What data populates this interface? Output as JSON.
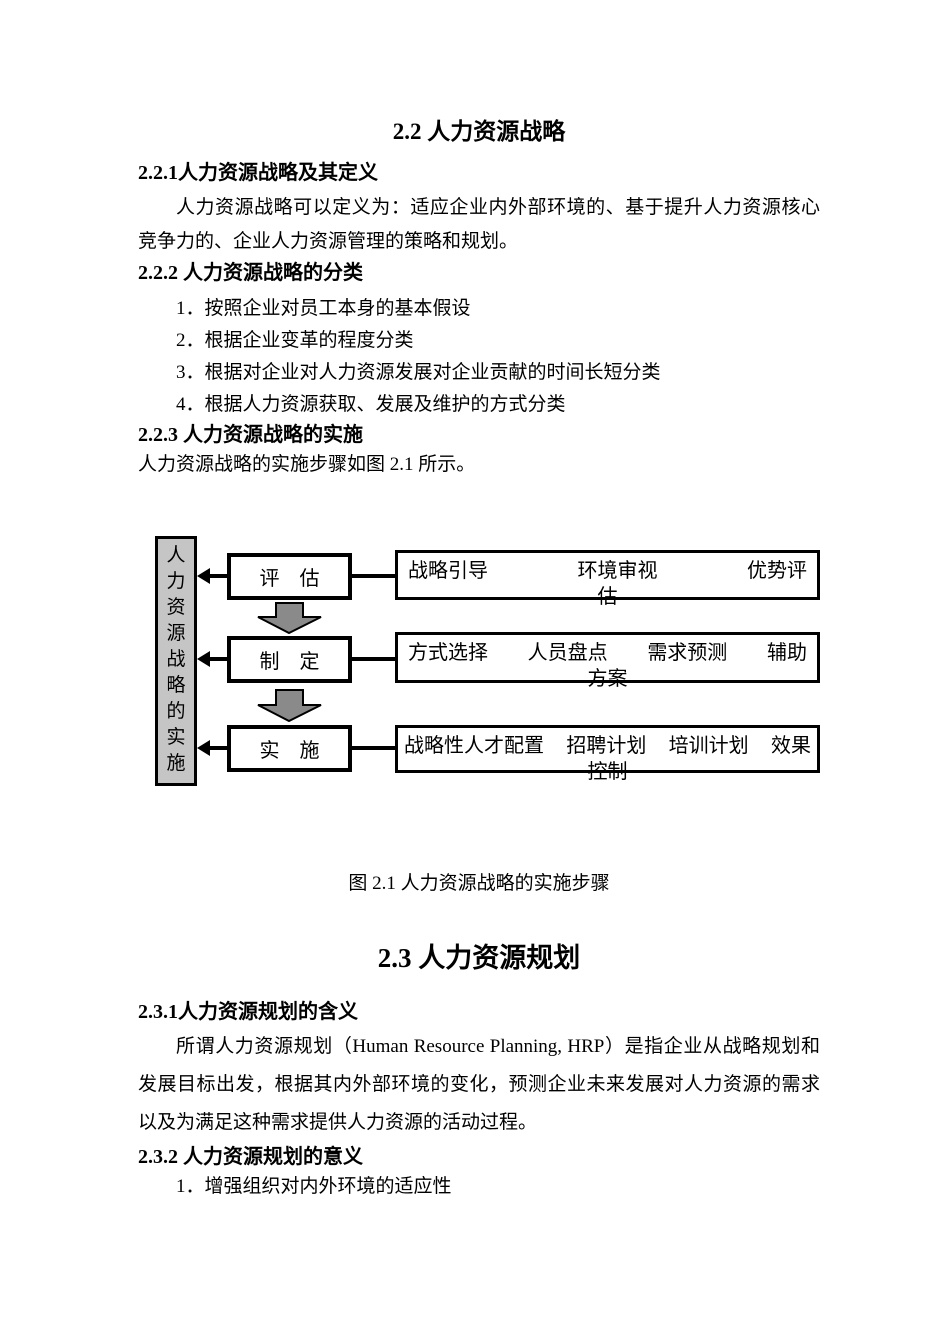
{
  "page": {
    "section2_2": {
      "title": "2.2 人力资源战略",
      "h221": "2.2.1人力资源战略及其定义",
      "para221": "人力资源战略可以定义为：适应企业内外部环境的、基于提升人力资源核心竞争力的、企业人力资源管理的策略和规划。",
      "h222": "2.2.2 人力资源战略的分类",
      "list222": [
        "1．按照企业对员工本身的基本假设",
        "2．根据企业变革的程度分类",
        "3．根据对企业对人力资源发展对企业贡献的时间长短分类",
        "4．根据人力资源获取、发展及维护的方式分类"
      ],
      "h223": "2.2.3 人力资源战略的实施",
      "intro223": "人力资源战略的实施步骤如图 2.1 所示。"
    },
    "diagram": {
      "side_label": "人力资源战略的实施",
      "rows": [
        {
          "step": "评　估",
          "parts": [
            "战略引导",
            "环境审视",
            "优势评"
          ],
          "overflow": "估"
        },
        {
          "step": "制　定",
          "parts": [
            "方式选择",
            "人员盘点",
            "需求预测",
            "辅助"
          ],
          "overflow": "方案"
        },
        {
          "step": "实　施",
          "parts": [
            "战略性人才配置",
            "招聘计划",
            "培训计划",
            "效果"
          ],
          "overflow": "控制"
        }
      ],
      "colors": {
        "side_box_fill": "#c5c5c5",
        "down_arrow_fill": "#8a8a8a",
        "line_color": "#000000",
        "box_background": "#ffffff"
      }
    },
    "caption": "图 2.1 人力资源战略的实施步骤",
    "section2_3": {
      "title": "2.3 人力资源规划",
      "h231": "2.3.1人力资源规划的含义",
      "para231": "所谓人力资源规划（Human Resource Planning, HRP）是指企业从战略规划和发展目标出发，根据其内外部环境的变化，预测企业未来发展对人力资源的需求以及为满足这种需求提供人力资源的活动过程。",
      "h232": "2.3.2 人力资源规划的意义",
      "list232": [
        "1．增强组织对内外环境的适应性"
      ]
    }
  }
}
